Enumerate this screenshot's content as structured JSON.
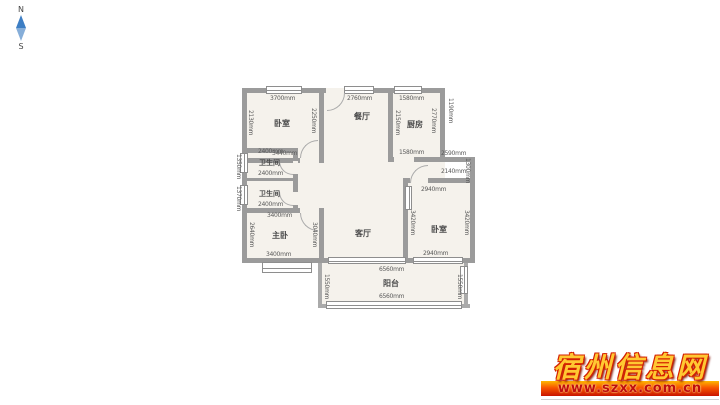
{
  "compass": {
    "north": "N",
    "south": "S"
  },
  "plan": {
    "rooms": [
      {
        "label": "卧室"
      },
      {
        "label": "餐厅"
      },
      {
        "label": "厨房"
      },
      {
        "label": "卫生间"
      },
      {
        "label": "卫生间"
      },
      {
        "label": "主卧"
      },
      {
        "label": "客厅"
      },
      {
        "label": "卧室"
      },
      {
        "label": "阳台"
      }
    ],
    "dims": [
      {
        "t": "3700mm"
      },
      {
        "t": "3440mm"
      },
      {
        "t": "2130mm"
      },
      {
        "t": "2250mm"
      },
      {
        "t": "2760mm"
      },
      {
        "t": "1580mm"
      },
      {
        "t": "1580mm"
      },
      {
        "t": "2150mm"
      },
      {
        "t": "2770mm"
      },
      {
        "t": "2400mm"
      },
      {
        "t": "2400mm"
      },
      {
        "t": "2400mm"
      },
      {
        "t": "1350mm"
      },
      {
        "t": "1370mm"
      },
      {
        "t": "3400mm"
      },
      {
        "t": "3400mm"
      },
      {
        "t": "2640mm"
      },
      {
        "t": "3040mm"
      },
      {
        "t": "2590mm"
      },
      {
        "t": "2140mm"
      },
      {
        "t": "1300mm"
      },
      {
        "t": "2940mm"
      },
      {
        "t": "2940mm"
      },
      {
        "t": "3420mm"
      },
      {
        "t": "3420mm"
      },
      {
        "t": "6560mm"
      },
      {
        "t": "6560mm"
      },
      {
        "t": "1550mm"
      },
      {
        "t": "1550mm"
      },
      {
        "t": "1190mm"
      }
    ]
  },
  "watermark": {
    "site": "宿州信息网",
    "url": "www.szxx.com.cn"
  }
}
